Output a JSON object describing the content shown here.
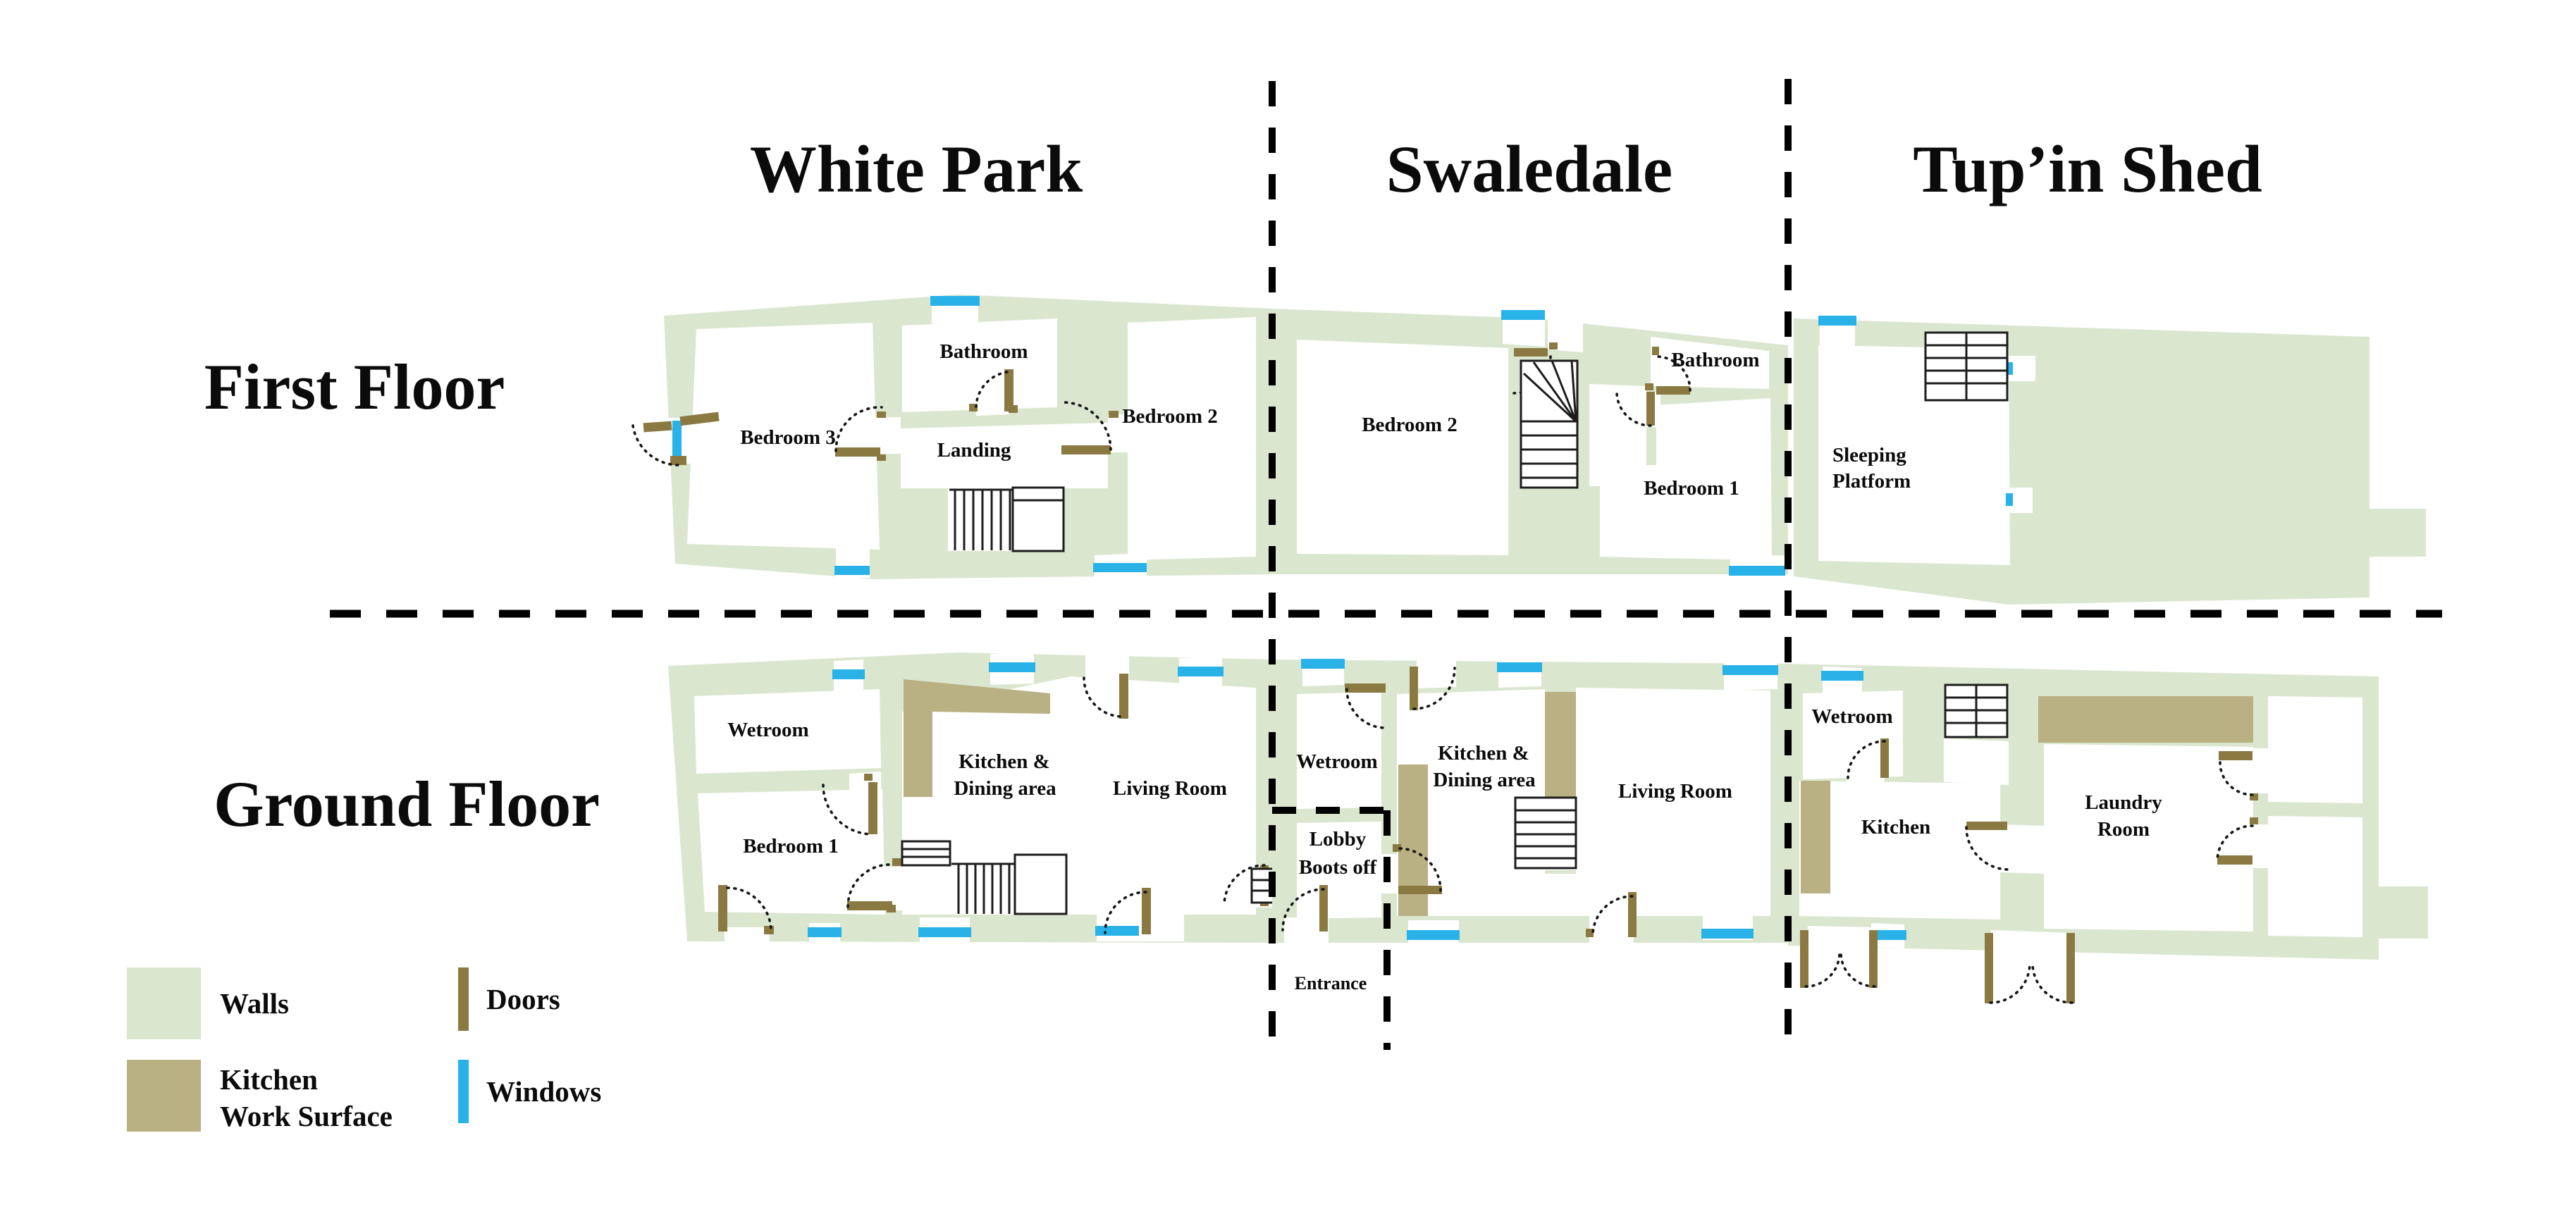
{
  "titles": {
    "white_park": "White Park",
    "swaledale": "Swaledale",
    "tupin_shed": "Tup’in Shed"
  },
  "floors": {
    "first": "First Floor",
    "ground": "Ground Floor"
  },
  "rooms": {
    "wp_ff": {
      "bedroom3": "Bedroom 3",
      "bathroom": "Bathroom",
      "landing": "Landing",
      "bedroom2": "Bedroom 2"
    },
    "sw_ff": {
      "bedroom2": "Bedroom 2",
      "bathroom": "Bathroom",
      "bedroom1": "Bedroom 1"
    },
    "ts_ff": {
      "sleeping_line1": "Sleeping",
      "sleeping_line2": "Platform"
    },
    "wp_gf": {
      "wetroom": "Wetroom",
      "bedroom1": "Bedroom 1",
      "kitchen_line1": "Kitchen &",
      "kitchen_line2": "Dining area",
      "living": "Living Room"
    },
    "sw_gf": {
      "wetroom": "Wetroom",
      "lobby_line1": "Lobby",
      "lobby_line2": "Boots off",
      "kitchen_line1": "Kitchen &",
      "kitchen_line2": "Dining area",
      "living": "Living Room",
      "entrance": "Entrance"
    },
    "ts_gf": {
      "wetroom": "Wetroom",
      "kitchen": "Kitchen",
      "laundry_line1": "Laundry",
      "laundry_line2": "Room"
    }
  },
  "legend": {
    "walls": "Walls",
    "kitchen_line1": "Kitchen",
    "kitchen_line2": "Work Surface",
    "doors": "Doors",
    "windows": "Windows"
  },
  "colors": {
    "walls": "#dbe6cf",
    "kitchen_surface": "#b9b083",
    "doors": "#8a7a42",
    "windows": "#29b2e8",
    "text": "#0b0b0b",
    "background": "#ffffff"
  }
}
